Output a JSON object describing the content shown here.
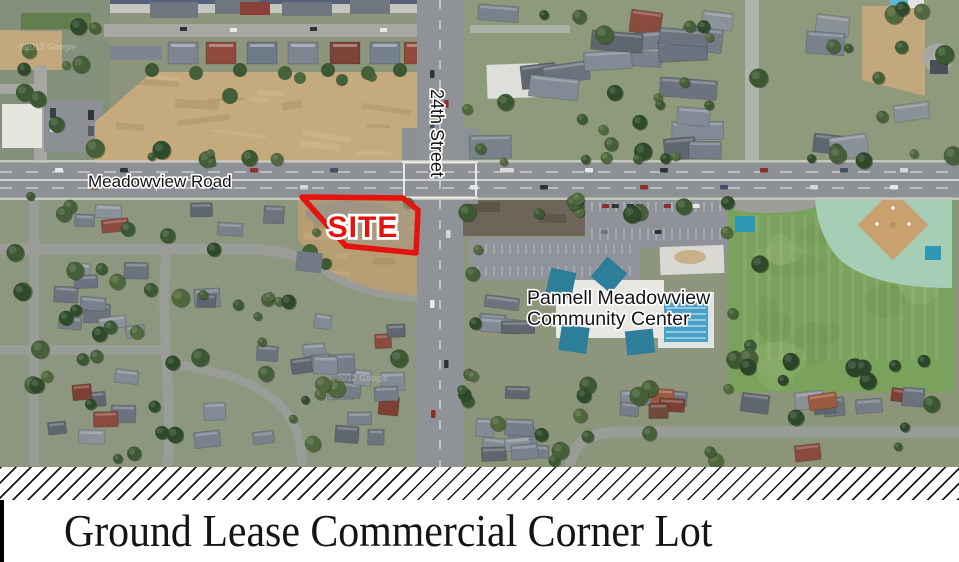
{
  "map": {
    "labels": {
      "horizontal_road": "Meadowview Road",
      "vertical_road": "24th Street",
      "site_marker": "SITE",
      "community_center_line1": "Pannell Meadowview",
      "community_center_line2": "Community Center",
      "watermark": "©2012 Google"
    },
    "colors": {
      "site_outline_red": "#e3140f",
      "label_black": "#141414",
      "label_halo_white": "#ffffff",
      "dry_field_tan": "#c4aa7c",
      "asphalt_gray": "#8d9094",
      "park_green": "#7ba25c",
      "outfield_green": "#a6cdb6",
      "infield_tan": "#c9a06e",
      "pool_blue": "#49a0c6",
      "canopy_teal": "#2f99b5"
    }
  },
  "footer": {
    "title": "Ground Lease Commercial Corner Lot"
  }
}
